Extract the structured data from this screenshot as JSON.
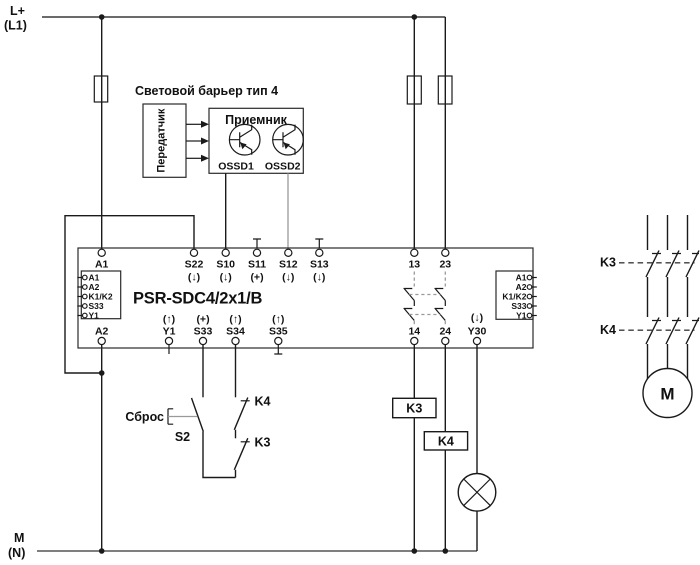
{
  "power": {
    "top_line1": "L+",
    "top_line2": "(L1)",
    "bottom_line1": "M",
    "bottom_line2": "(N)"
  },
  "light_barrier": {
    "title": "Световой барьер тип 4",
    "transmitter": "Передатчик",
    "receiver": "Приемник",
    "ossd1": "OSSD1",
    "ossd2": "OSSD2"
  },
  "relay": {
    "model": "PSR-SDC4/2x1/B",
    "left_connector": [
      "A1",
      "A2",
      "K1/K2",
      "S33",
      "Y1"
    ],
    "right_connector": [
      "A1",
      "A2",
      "K1/K2",
      "S33",
      "Y1"
    ],
    "top_terminals": [
      {
        "name": "A1",
        "ann": ""
      },
      {
        "name": "S22",
        "ann": "(↓)"
      },
      {
        "name": "S10",
        "ann": "(↓)"
      },
      {
        "name": "S11",
        "ann": "(+)"
      },
      {
        "name": "S12",
        "ann": "(↓)"
      },
      {
        "name": "S13",
        "ann": "(↓)"
      },
      {
        "name": "13",
        "ann": ""
      },
      {
        "name": "23",
        "ann": ""
      }
    ],
    "bottom_terminals": [
      {
        "name": "A2",
        "ann": ""
      },
      {
        "name": "Y1",
        "ann": "(↑)"
      },
      {
        "name": "S33",
        "ann": "(+)"
      },
      {
        "name": "S34",
        "ann": "(↑)"
      },
      {
        "name": "S35",
        "ann": "(↑)"
      },
      {
        "name": "14",
        "ann": ""
      },
      {
        "name": "24",
        "ann": ""
      },
      {
        "name": "Y30",
        "ann": "(↓)"
      }
    ]
  },
  "reset_circuit": {
    "label": "Сброс",
    "button": "S2",
    "contact_top": "K4",
    "contact_bottom": "K3"
  },
  "coils": {
    "k3": "K3",
    "k4": "K4"
  },
  "motor_circuit": {
    "contactor_top": "K3",
    "contactor_bottom": "K4",
    "motor": "M"
  },
  "colors": {
    "line": "#1a1a1a",
    "secondary": "#999999"
  }
}
